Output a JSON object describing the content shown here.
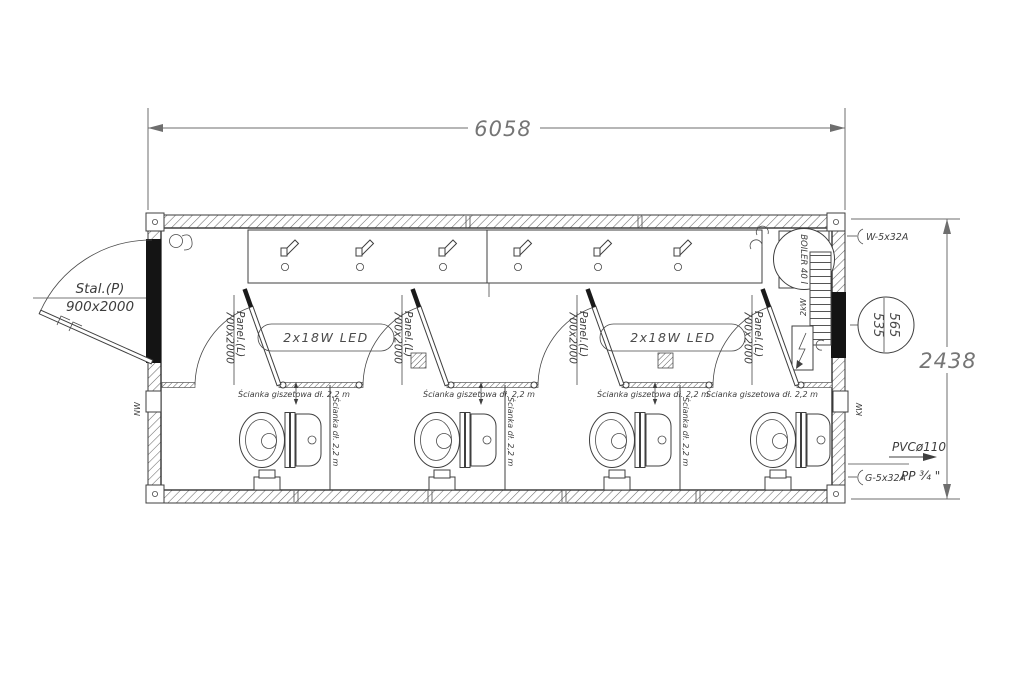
{
  "dimensions": {
    "width": "6058",
    "height": "2438"
  },
  "entrance_door": {
    "type": "Stal.(P)",
    "size": "900x2000"
  },
  "stall_door": {
    "type": "Panel.(L)",
    "size": "700x2000"
  },
  "lighting": {
    "label": "2x18W LED"
  },
  "partitions": {
    "front_label": "Ścianka giszetowa dł. 2,2 m",
    "side_label": "Ścianka dł. 2,2 m"
  },
  "equipment": {
    "boiler": "BOILER 40 l",
    "heater_power": "2kW"
  },
  "window_marker": {
    "width": "565",
    "height": "535"
  },
  "connections": {
    "electrical": "W-5x32A",
    "water_supply": "G-5x32A",
    "water_pipe": "PP ¾ \"",
    "sewage": "PVCø110",
    "vent_right": "KW",
    "vent_left": "NW"
  },
  "colors": {
    "line": "#3f3f3f",
    "dim_text": "#757575",
    "fill_black": "#141414",
    "background": "#ffffff"
  }
}
